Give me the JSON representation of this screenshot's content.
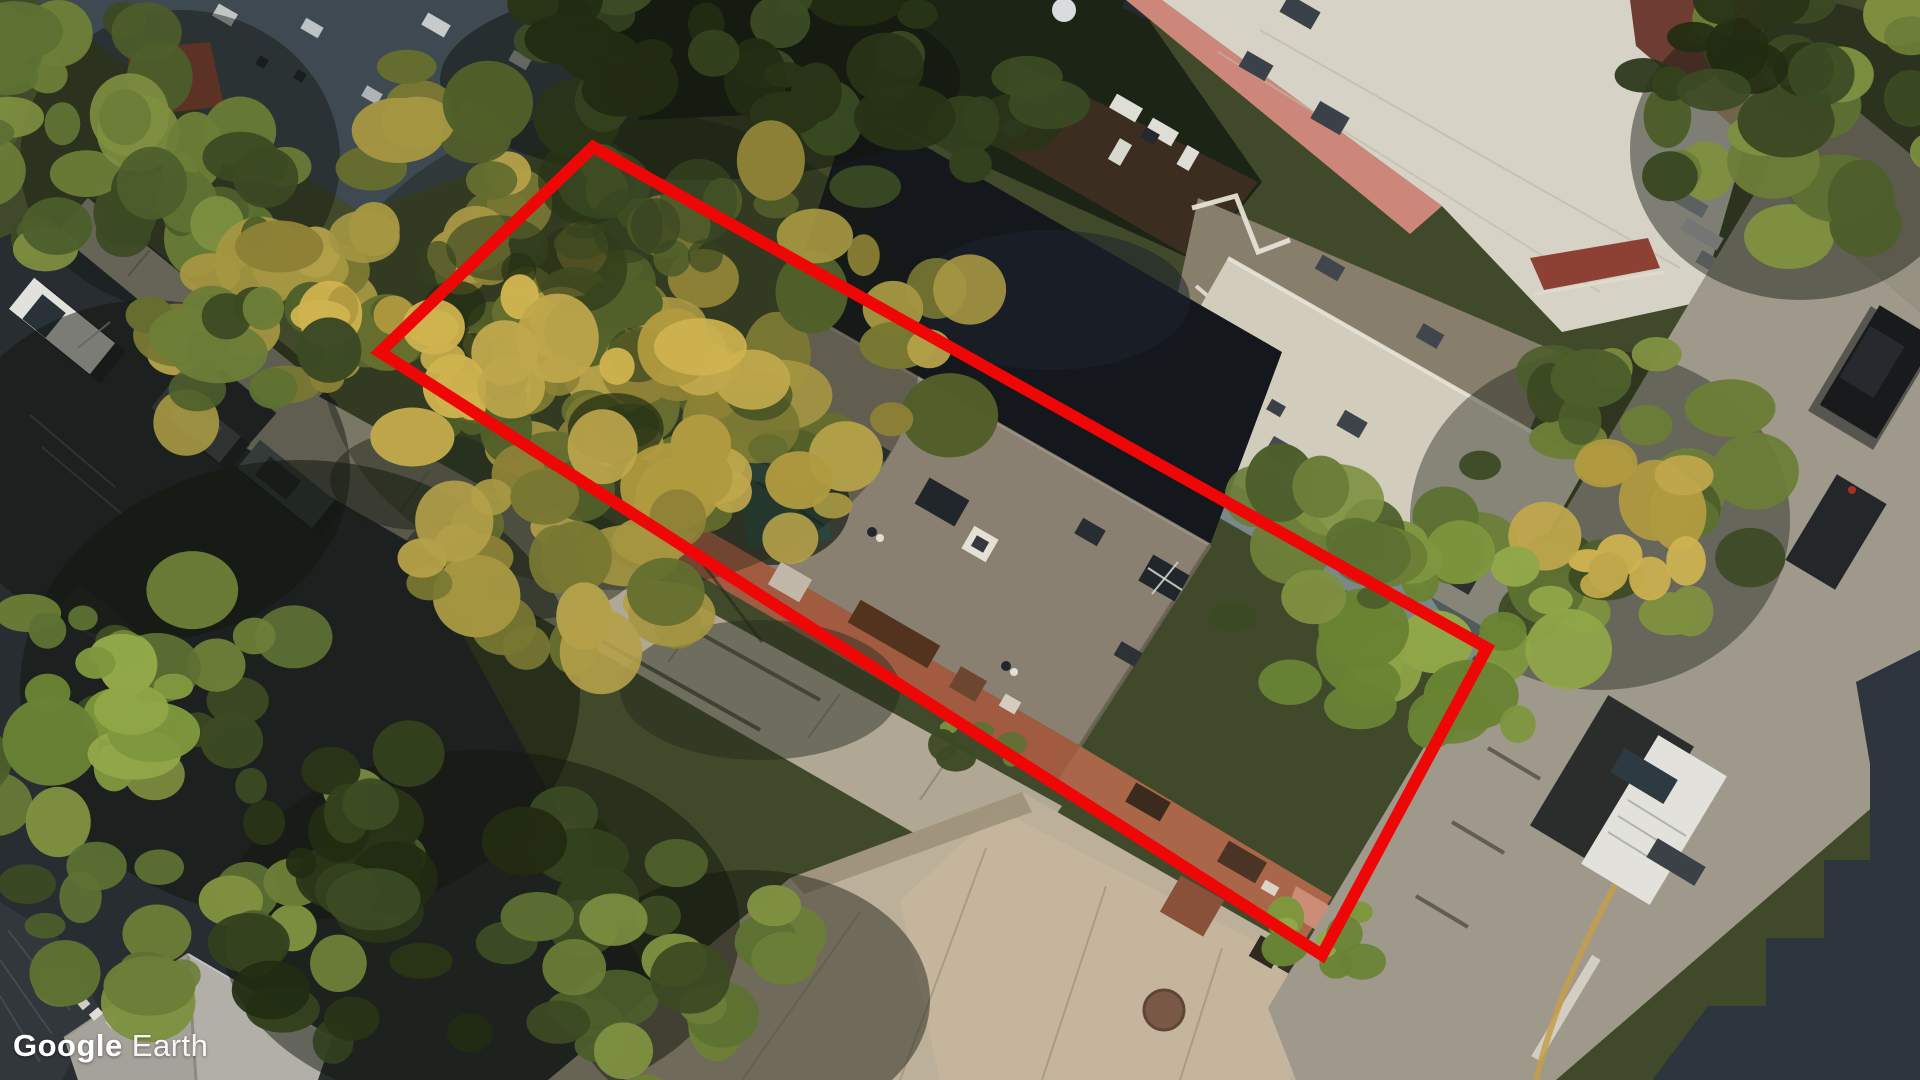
{
  "watermark": {
    "brand": "Google",
    "product": "Earth"
  },
  "view": {
    "type": "aerial-satellite-oblique",
    "description": "Oblique aerial imagery of a city block with tree canopy, flat-roofed buildings, streets and parked cars"
  },
  "annotation": {
    "parcel_outline": {
      "points": "593,147 1487,648 1322,955 380,352",
      "color": "#ef0606",
      "stroke_width": 12
    }
  },
  "palette": {
    "base_ground": "#3f4a2c",
    "asphalt_street": "#262c33",
    "sidewalk": "#b0a896",
    "plaza_concrete": "#c1b5a0",
    "right_street": "#a29d90",
    "subject_roof": "#8c8376",
    "dark_roof": "#11161d",
    "white_roof": "#d7d2c4",
    "pink_facade": "#d28a7e",
    "brick_band": "#a45c42",
    "brick_band_se": "#ad684a",
    "slate_roof": "#3d4954",
    "red_roof_patch": "#9c4937",
    "maroon_roof": "#6e3c33",
    "mid_roof": "#8a8070",
    "roof_shadow_band": "#8695a2",
    "canopy_yellow": [
      "#8f8438",
      "#a89944",
      "#b7a44b",
      "#7a7a34",
      "#65702f",
      "#51602a"
    ],
    "canopy_gold": [
      "#c3ab4e",
      "#d4b852",
      "#b49e41"
    ],
    "tree_green": [
      "#5d7334",
      "#6d8039",
      "#4c5f2c",
      "#7f9342",
      "#3b4a24"
    ],
    "tree_dark": [
      "#31411f",
      "#273317",
      "#3a4c25",
      "#202b12"
    ],
    "tree_bright": [
      "#7f9a3f",
      "#93ab4a",
      "#6a8636"
    ],
    "car_white": "#e8e8e4",
    "car_black": "#15181d",
    "lane_yellow": "#c9a24e",
    "watermark_color": "#ffffff"
  }
}
